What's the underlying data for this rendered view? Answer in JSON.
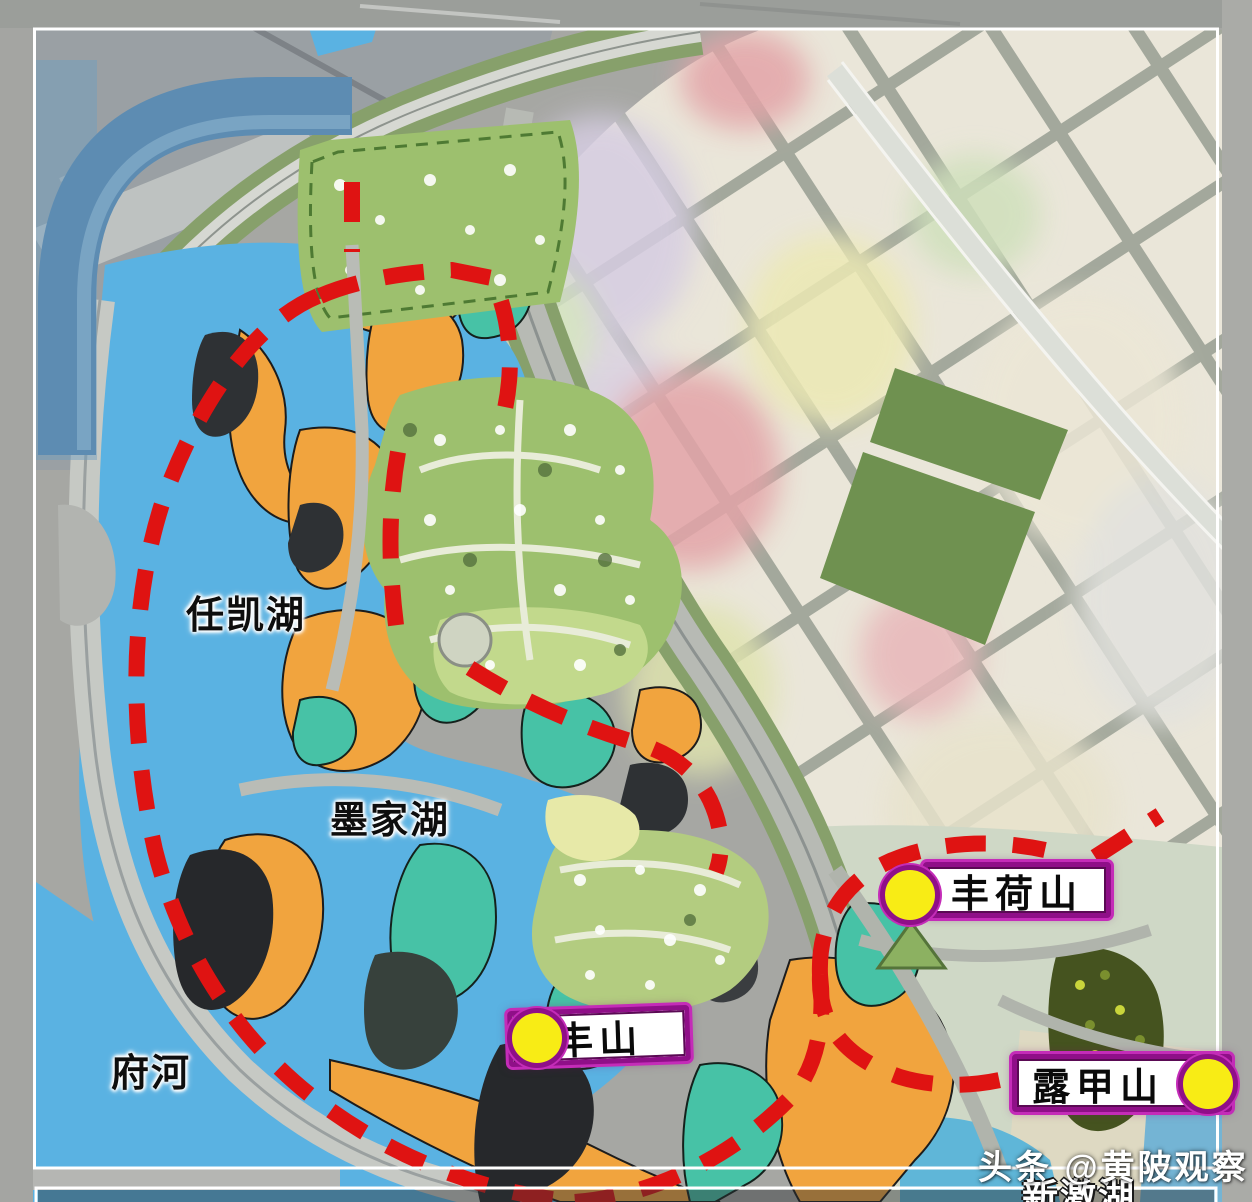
{
  "map": {
    "labels": {
      "renkai_lake": "任凯湖",
      "mojia_lake": "墨家湖",
      "fu_river": "府河",
      "xinji_lake": "新激湖",
      "fenghe_mountain": "丰荷山",
      "feng_mountain": "丰山",
      "lujia_mountain": "露甲山"
    },
    "watermark": "头条 @黄陂观察",
    "colors": {
      "water_blue": "#5ab2e2",
      "pond_blue": "#3f86c8",
      "boundary_red": "#df1312",
      "zone_orange": "#f1a43e",
      "zone_teal": "#47c2a6",
      "zone_dark": "#2e3134",
      "dev_green": "#9dc06e",
      "dev_green_light": "#c2d98c",
      "park_green": "#6f9150",
      "sage_green": "#87a06b",
      "pale_area": "#cfd8c6",
      "road_light": "#cfd2cc",
      "satellite_gray": "#a6a7a3",
      "band_blue": "#5d8cb2",
      "veg_dark": "#45531f",
      "marker_yellow": "#f8ec15",
      "marker_border": "#8f0f88",
      "triangle_green": "#8cb161",
      "frame_white": "#ffffff"
    }
  }
}
